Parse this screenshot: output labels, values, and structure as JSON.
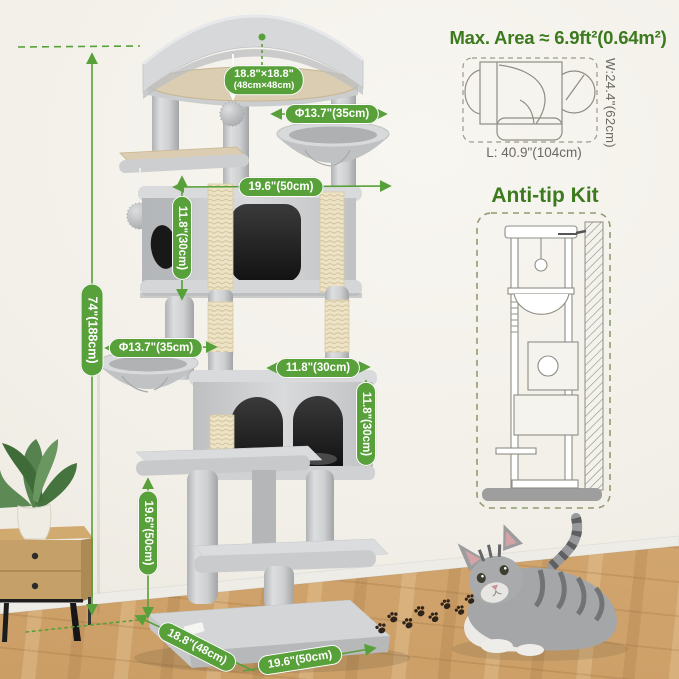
{
  "colors": {
    "accent": "#58a03a",
    "heading": "#3c7a1d",
    "info_text": "#6a6a60"
  },
  "dims": {
    "total_height": "74\"(188cm)",
    "top_platform": "18.8\"×18.8\"",
    "top_platform_cm": "(48cm×48cm)",
    "top_basket_diameter": "Φ13.7\"(35cm)",
    "middle_width": "19.6\"(50cm)",
    "upper_condo_height": "11.8\"(30cm)",
    "lower_basket_diameter": "Φ13.7\"(35cm)",
    "lower_condo_width": "11.8\"(30cm)",
    "lower_condo_height": "11.8\"(30cm)",
    "lower_section_height": "19.6\"(50cm)",
    "base_depth": "18.8\"(48cm)",
    "base_width": "19.6\"(50cm)"
  },
  "max_area": {
    "title": "Max. Area ≈ 6.9ft²(0.64m²)",
    "width": "W:24.4\"(62cm)",
    "length": "L: 40.9\"(104cm)"
  },
  "anti_tip": {
    "title": "Anti-tip Kit"
  }
}
